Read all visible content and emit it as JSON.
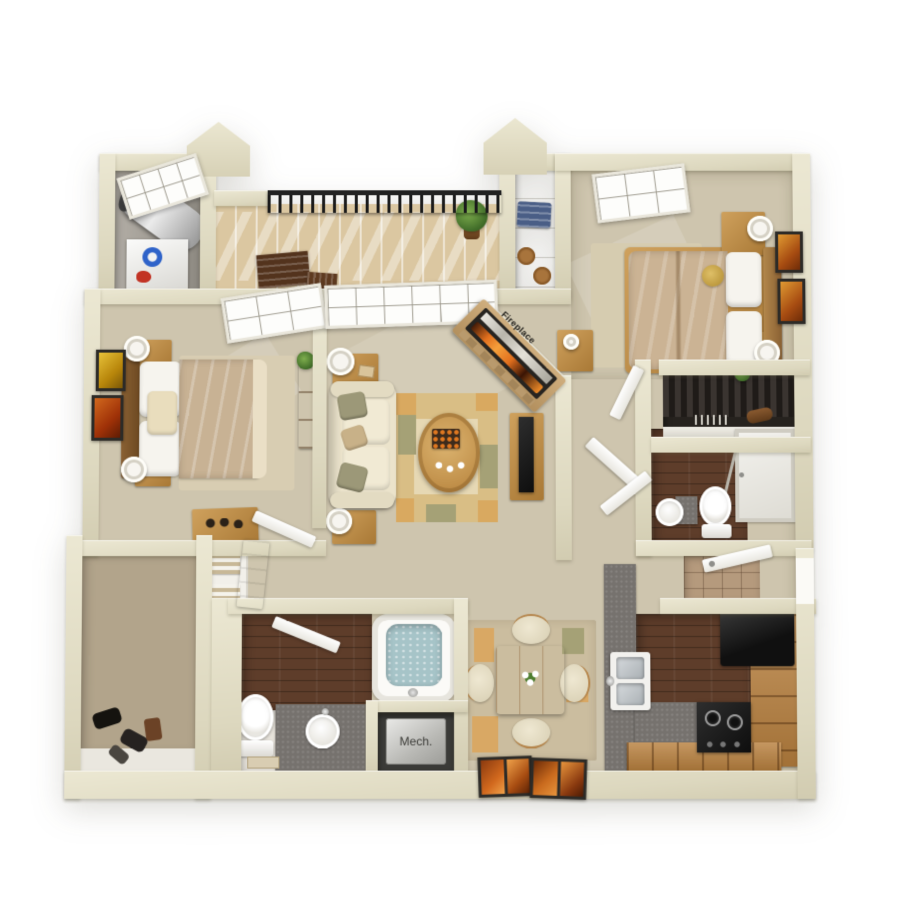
{
  "labels": {
    "fireplace": "Fireplace",
    "mech": "Mech."
  },
  "palette": {
    "background": "#ffffff",
    "wall": "#e6e2cb",
    "wall_shadow": "#cfcab0",
    "carpet": "#cec5ae",
    "dark_wood_floor": "#5e3d2a",
    "deck_wood": "#dbc7a1",
    "walkin_floor": "#b2a48b",
    "entry_tile": "#b59a7d",
    "rug_tan": "#d9be85",
    "rug_olive": "#a5a176",
    "counter_gray": "#76726e",
    "cabinet_wood": "#b9813f",
    "appliance_black": "#1c1c1c",
    "flame_orange": "#e2701e",
    "tub_water": "#a6c4c8",
    "linen_white": "#f4f2ec",
    "bedding_tan": "#c8b294",
    "sofa_cream": "#ebe3cb",
    "plant_green": "#4e7d2f",
    "railing_black": "#1b1b1b",
    "art_orange": "#c96a1e"
  }
}
